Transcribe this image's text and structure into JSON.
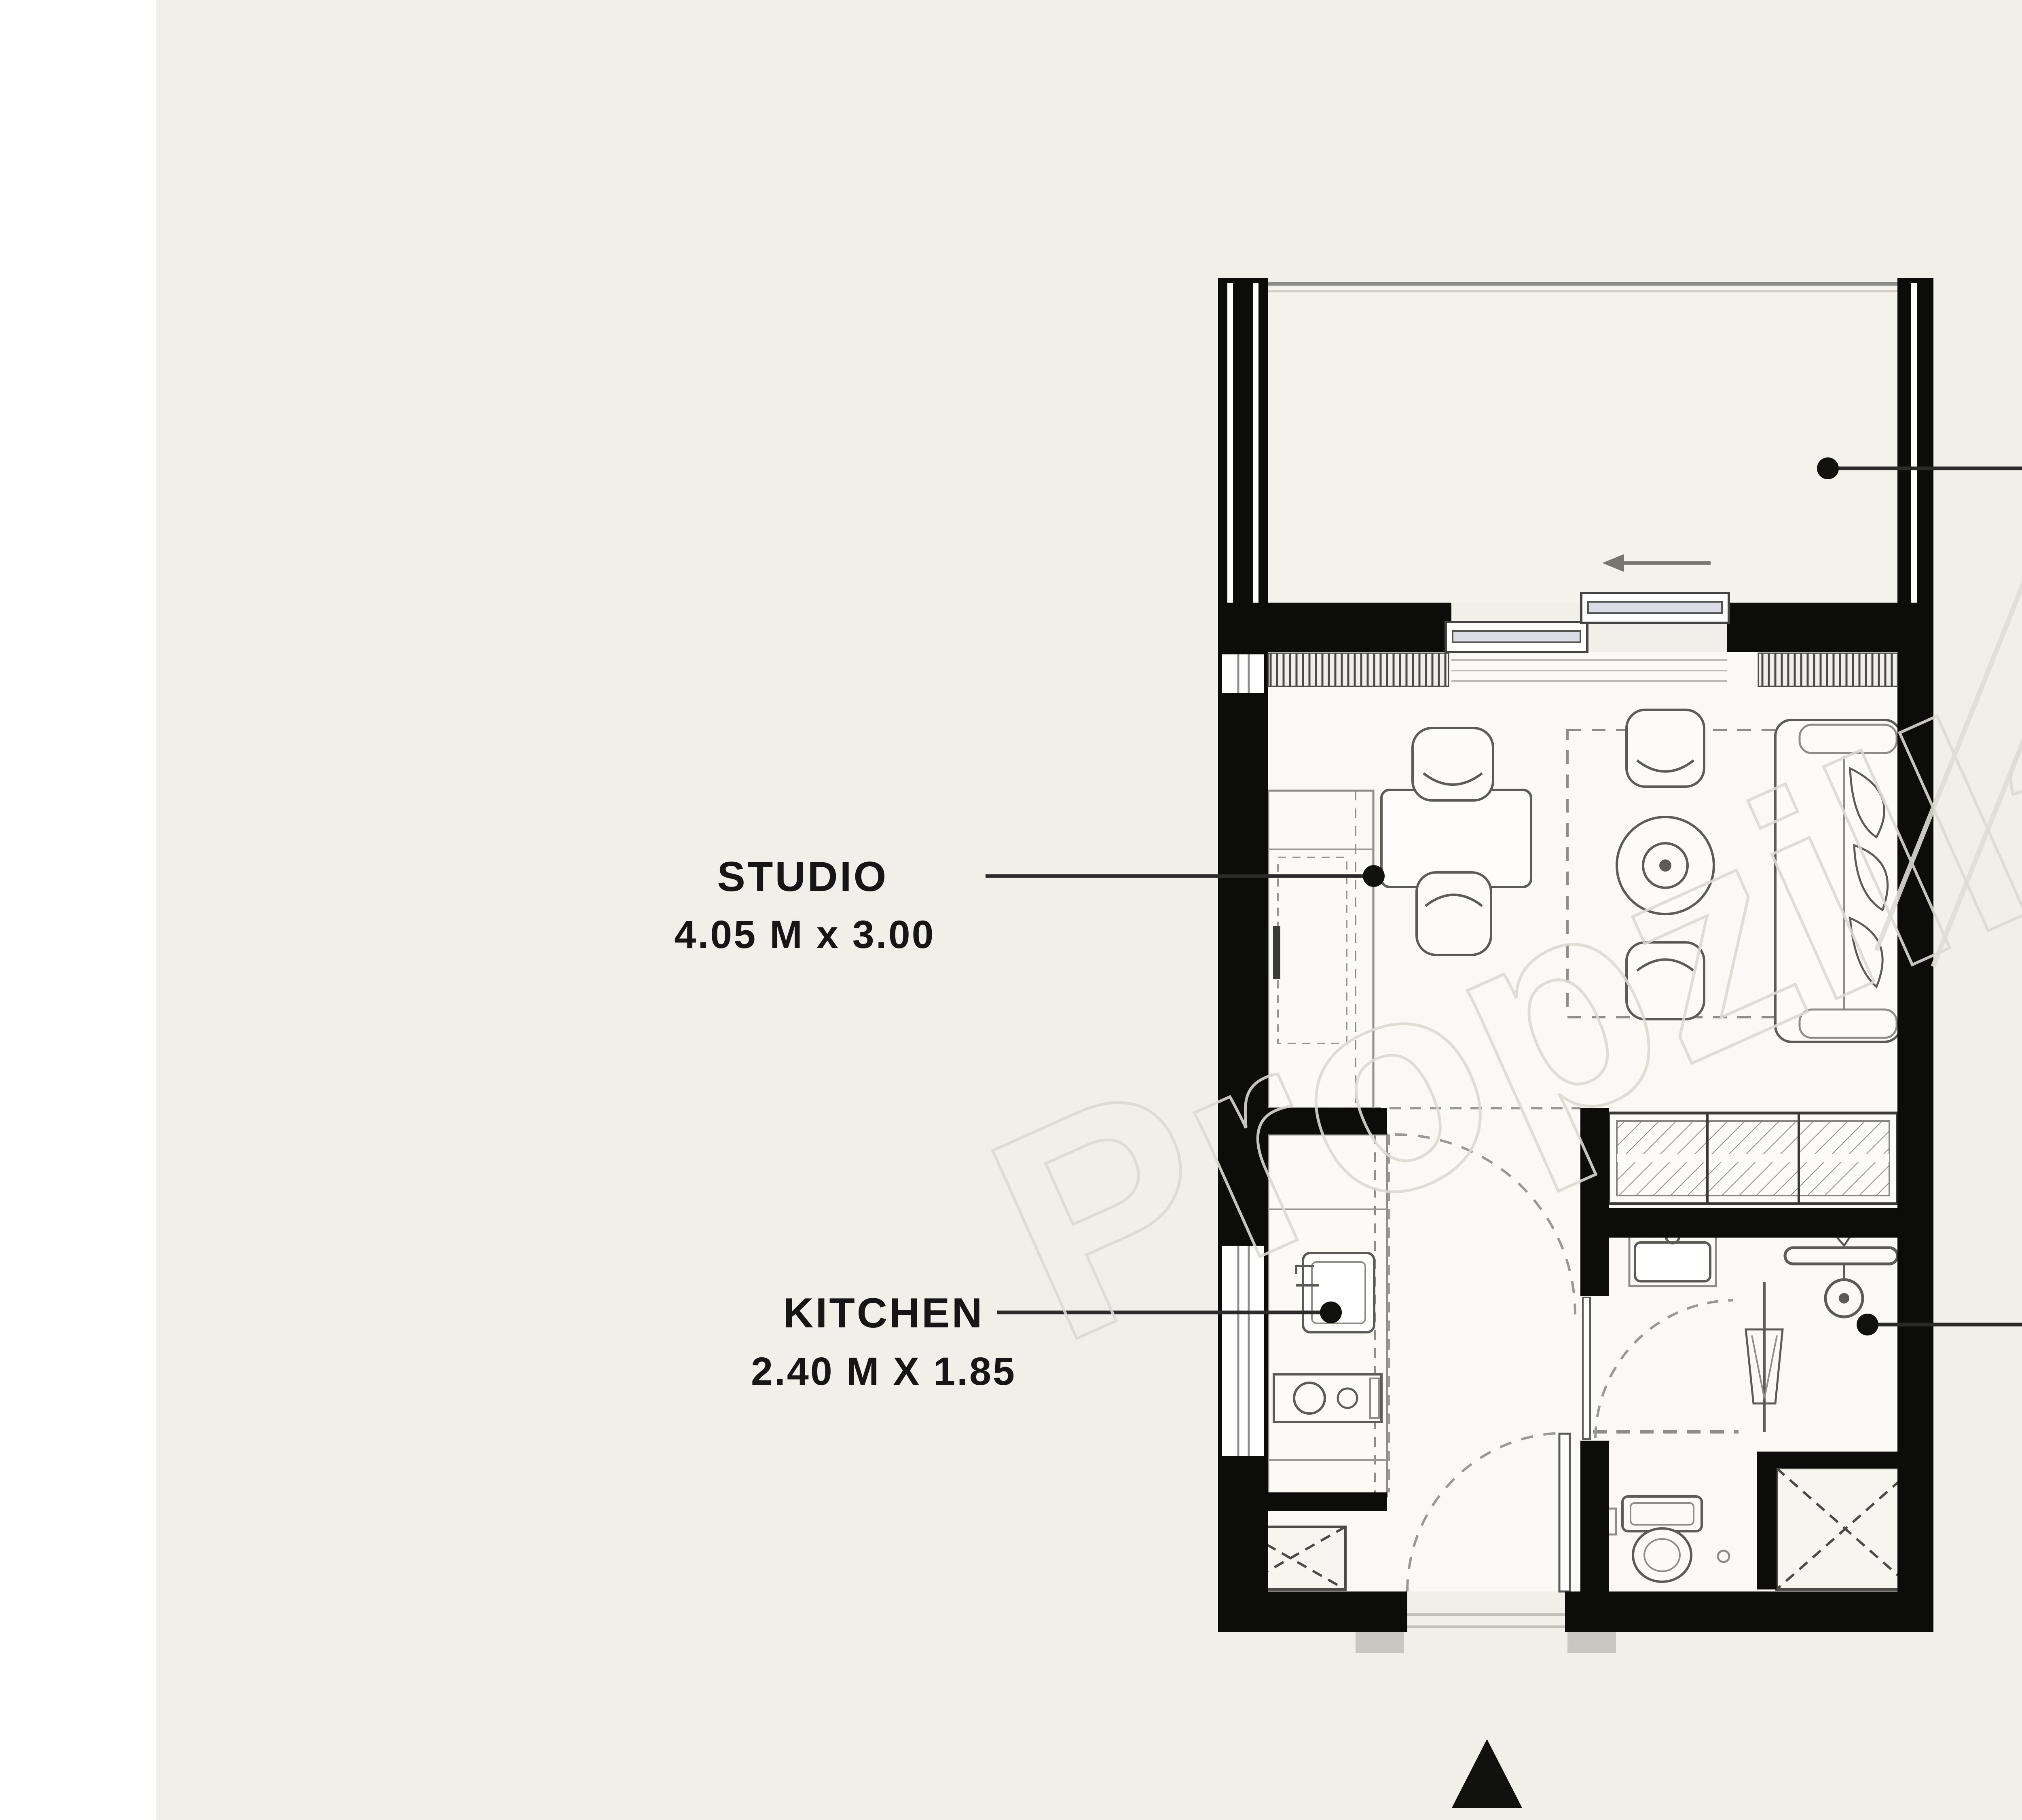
{
  "watermark": {
    "text": "Propzilla",
    "registered_mark": "®"
  },
  "rooms": [
    {
      "id": "terrace",
      "label": "TERRACE",
      "dimensions": "3.95 M X 1.75"
    },
    {
      "id": "studio",
      "label": "STUDIO",
      "dimensions": "4.05 M x 3.00"
    },
    {
      "id": "kitchen",
      "label": "KITCHEN",
      "dimensions": "2.40 M X 1.85"
    },
    {
      "id": "bathroom",
      "label": "BATHROOM",
      "dimensions": "2.25 M X 2.00 M"
    }
  ],
  "colors": {
    "background": "#f1efe9",
    "side_margin": "#ffffff",
    "wall": "#0c0c0a",
    "room_fill": "#faf9f5",
    "terrace_fill": "#f4f2ec",
    "label_text": "#161616",
    "leader_line": "#2b2b2b",
    "furniture_stroke": "#5b5b57",
    "light_stroke": "#9a9892",
    "watermark": "#dcdad3"
  }
}
